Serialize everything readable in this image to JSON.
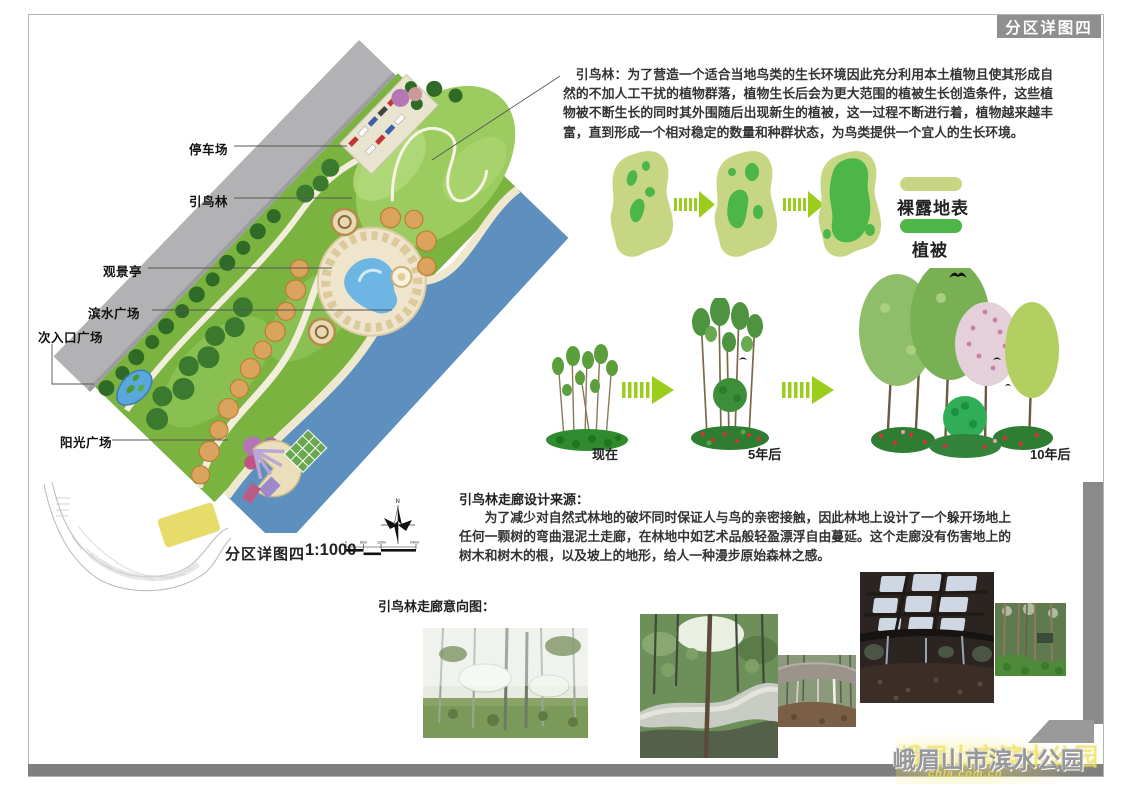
{
  "page": {
    "tag": "分区详图四",
    "project_title": "峨眉山市滨水公园",
    "watermark": "chla.com.cn"
  },
  "plan": {
    "labels": [
      {
        "text": "停车场"
      },
      {
        "text": "引鸟林"
      },
      {
        "text": "观景亭"
      },
      {
        "text": "滨水广场"
      },
      {
        "text": "次入口广场"
      },
      {
        "text": "阳光广场"
      }
    ],
    "caption": "分区详图四",
    "scale": "1:1000",
    "scalebar": {
      "ticks": [
        "0",
        "60m",
        "120m",
        "240m"
      ]
    },
    "compass": {
      "north": "N"
    }
  },
  "bird_forest": {
    "description": "引鸟林：为了营造一个适合当地鸟类的生长环境因此充分利用本土植物且使其形成自然的不加人工干扰的植物群落，植物生长后会为更大范围的植被生长创造条件，这些植物被不断生长的同时其外围随后出现新生的植被，这一过程不断进行着，植物越来越丰富，直到形成一个相对稳定的数量和种群状态，为鸟类提供一个宜人的生长环境。",
    "legend": [
      {
        "label": "裸露地表",
        "color": "#c6d682"
      },
      {
        "label": "植被",
        "color": "#4cb648"
      }
    ],
    "timeline": [
      {
        "label": "现在"
      },
      {
        "label": "5年后"
      },
      {
        "label": "10年后"
      }
    ]
  },
  "corridor": {
    "heading": "引鸟林走廊设计来源：",
    "body": "为了减少对自然式林地的破坏同时保证人与鸟的亲密接触，因此林地上设计了一个躲开场地上任何一颗树的弯曲混泥土走廊，在林地中如艺术品般轻盈漂浮自由蔓延。这个走廊没有伤害地上的树木和树木的根，以及坡上的地形，给人一种漫步原始森林之感。",
    "gallery_heading": "引鸟林走廊意向图：",
    "photos": [
      {
        "name": "misty-forest-treehouses"
      },
      {
        "name": "curving-concrete-walkway"
      },
      {
        "name": "concrete-canopy-pavilion"
      },
      {
        "name": "canopy-underside-skylights"
      },
      {
        "name": "pine-forest-ferns"
      }
    ]
  },
  "colors": {
    "accent_arrow_green": "#9ccc1c",
    "bare_ground": "#c6d682",
    "vegetation": "#4cb648",
    "river_blue": "#5d8fbf",
    "road_gray": "#b2b2b4",
    "frame_gray": "#7f7f7f"
  }
}
